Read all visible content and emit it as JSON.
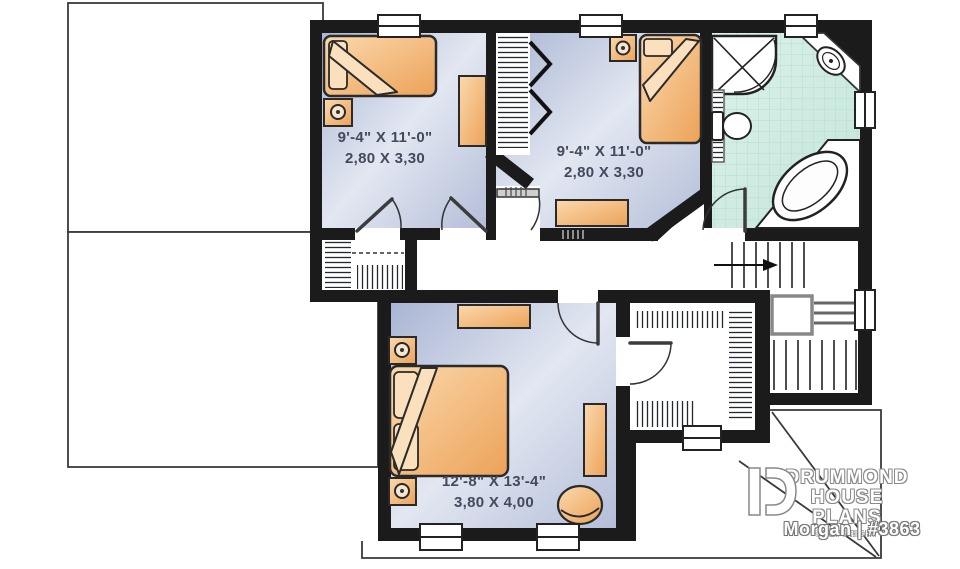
{
  "plan": {
    "brand": {
      "line1": "DRUMMOND",
      "line2": "HOUSE PLANS",
      "copyright": "©COPYRIGHT",
      "plan_id": "Morgan | #3863"
    },
    "rooms": [
      {
        "id": "bedroom-1",
        "dim_imperial": "9'-4\" X 11'-0\"",
        "dim_metric": "2,80 X 3,30"
      },
      {
        "id": "bedroom-2",
        "dim_imperial": "9'-4\" X 11'-0\"",
        "dim_metric": "2,80 X 3,30"
      },
      {
        "id": "master-bedroom",
        "dim_imperial": "12'-8\" X 13'-4\"",
        "dim_metric": "3,80 X 4,00"
      }
    ],
    "fixtures": [
      "bed",
      "nightstand-lamp",
      "dresser",
      "corner-shower",
      "toilet",
      "vanity-sink",
      "corner-bathtub",
      "linen-shelves",
      "closet-rod",
      "bifold-door",
      "stairs",
      "armchair"
    ],
    "colors": {
      "wall": "#1b1b1b",
      "bedroom_floor": "#aab6d4",
      "bedroom_floor_light": "#e3e8f2",
      "bathroom_tile": "#cfe9e0",
      "tile_grid": "#b7dcd3",
      "furniture": "#eca860",
      "furniture_light": "#fbdcb4",
      "roof_line": "#3a3a3a",
      "label_text": "#434a5e",
      "logo_text": "#ffffff"
    }
  }
}
